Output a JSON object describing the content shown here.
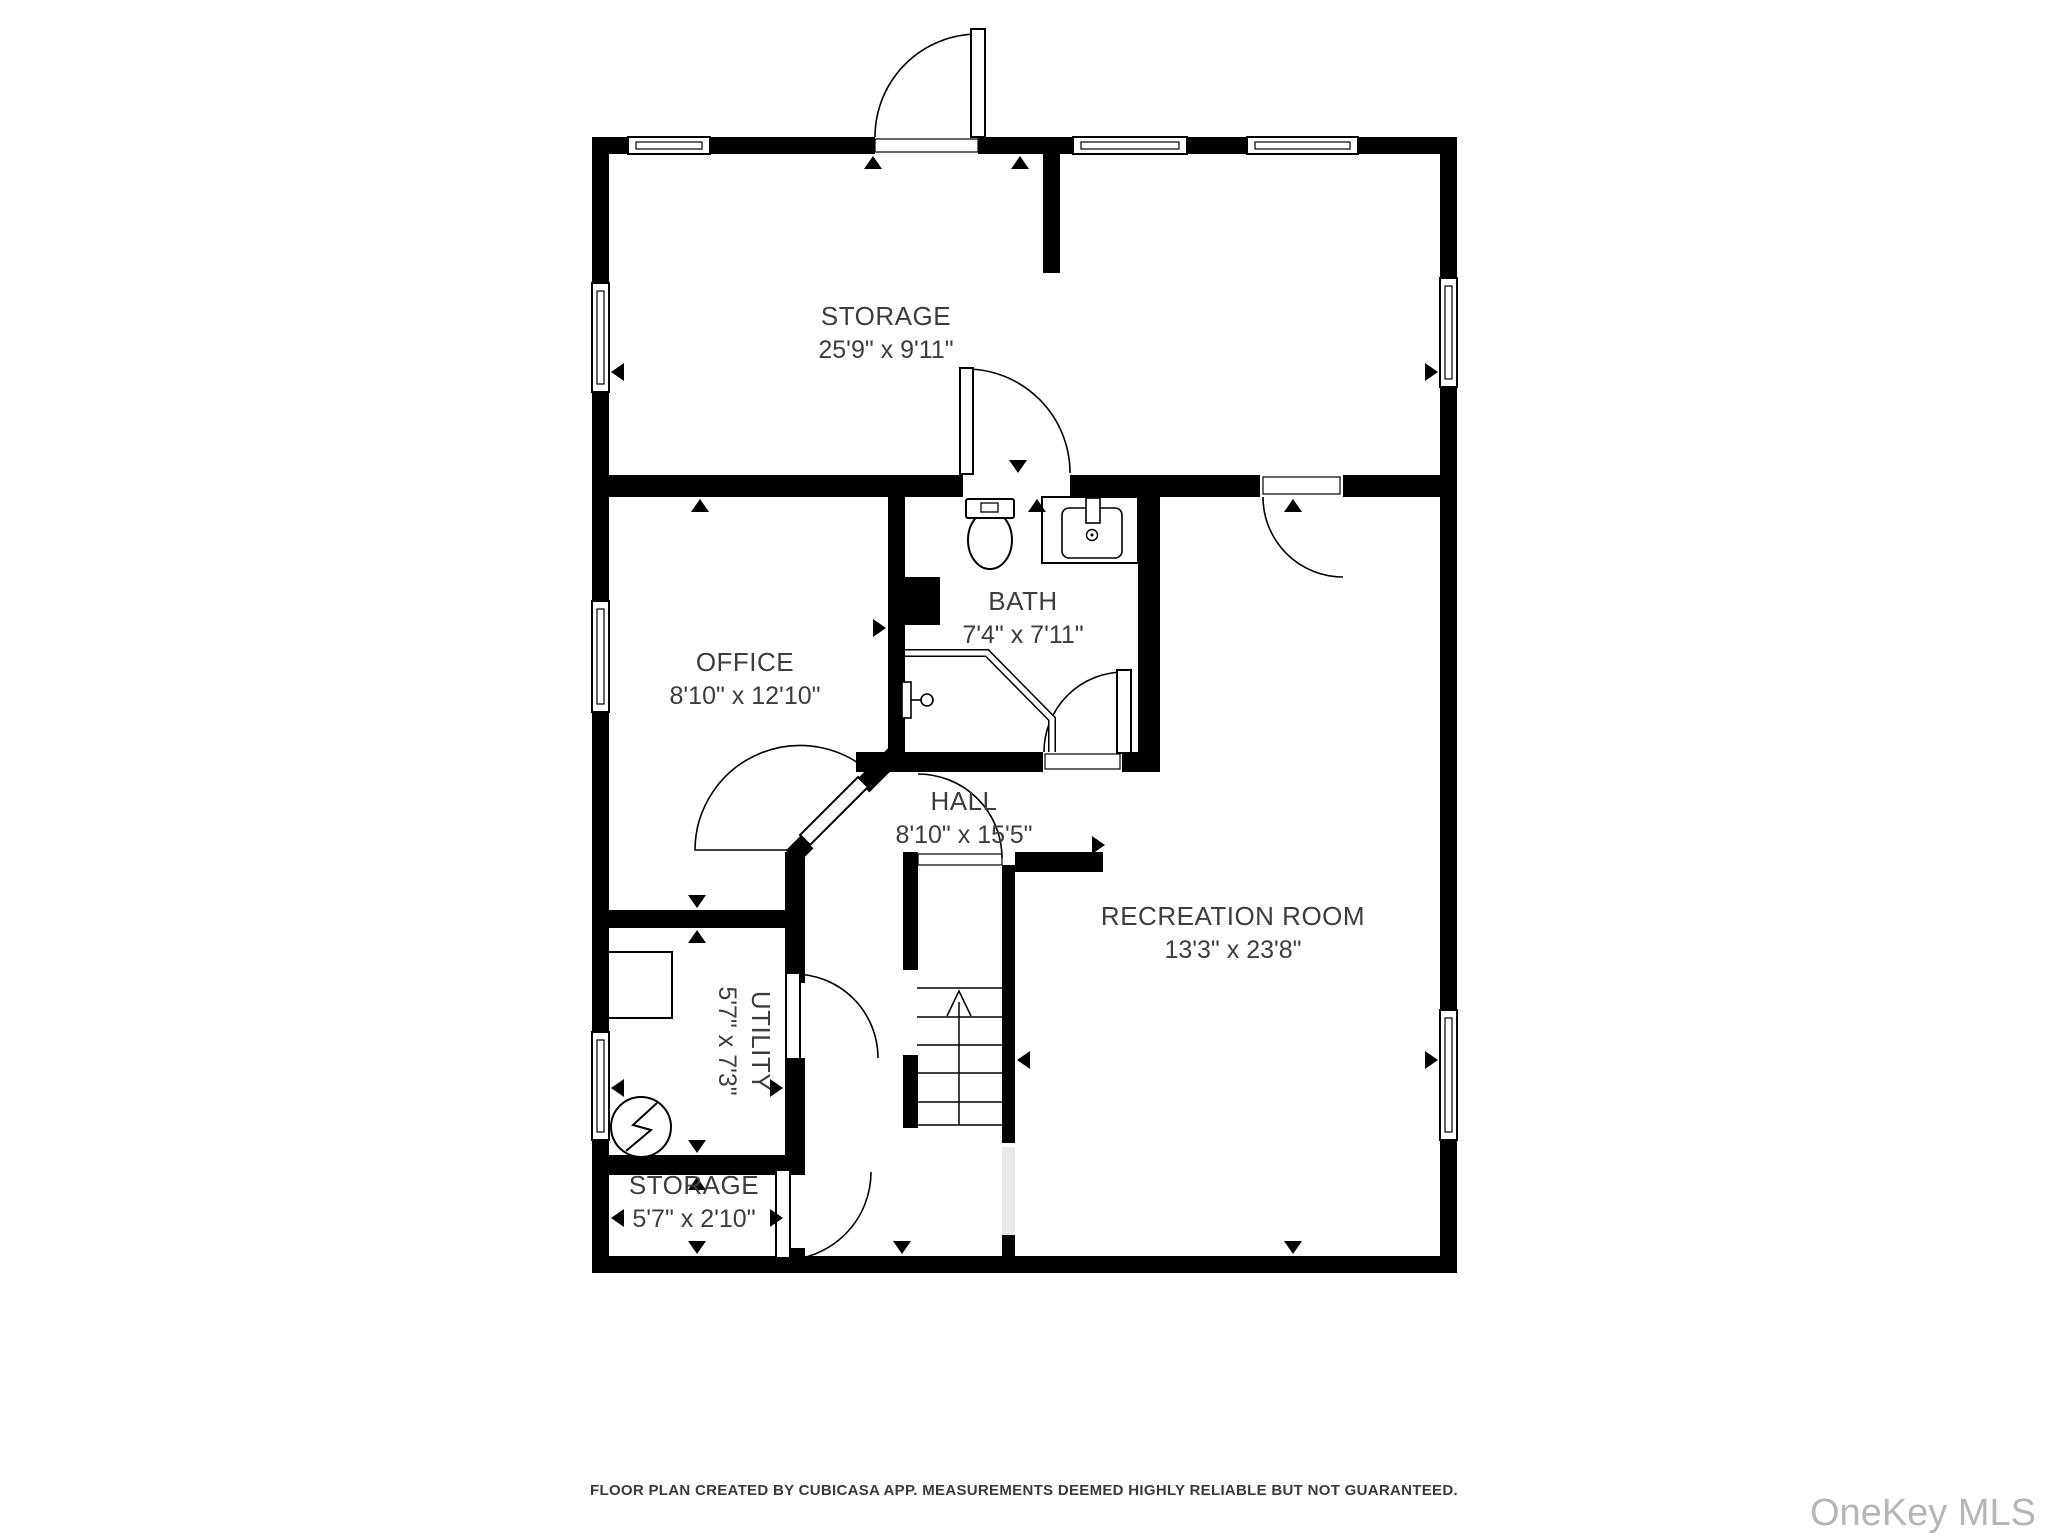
{
  "plan": {
    "rooms": [
      {
        "name": "STORAGE",
        "dims": "25'9\" x 9'11\""
      },
      {
        "name": "OFFICE",
        "dims": "8'10\" x 12'10\""
      },
      {
        "name": "BATH",
        "dims": "7'4\" x 7'11\""
      },
      {
        "name": "HALL",
        "dims": "8'10\" x 15'5\""
      },
      {
        "name": "RECREATION ROOM",
        "dims": "13'3\" x 23'8\""
      },
      {
        "name": "UTILITY",
        "dims": "5'7\" x 7'3\""
      },
      {
        "name": "STORAGE",
        "dims": "5'7\" x 2'10\""
      }
    ],
    "footer": "FLOOR PLAN CREATED BY CUBICASA APP. MEASUREMENTS DEEMED HIGHLY RELIABLE BUT NOT GUARANTEED.",
    "watermark": "OneKey MLS",
    "colors": {
      "wall": "#000000",
      "label": "#3d3d3d",
      "watermark": "#b6b6b9",
      "background": "#ffffff"
    }
  }
}
